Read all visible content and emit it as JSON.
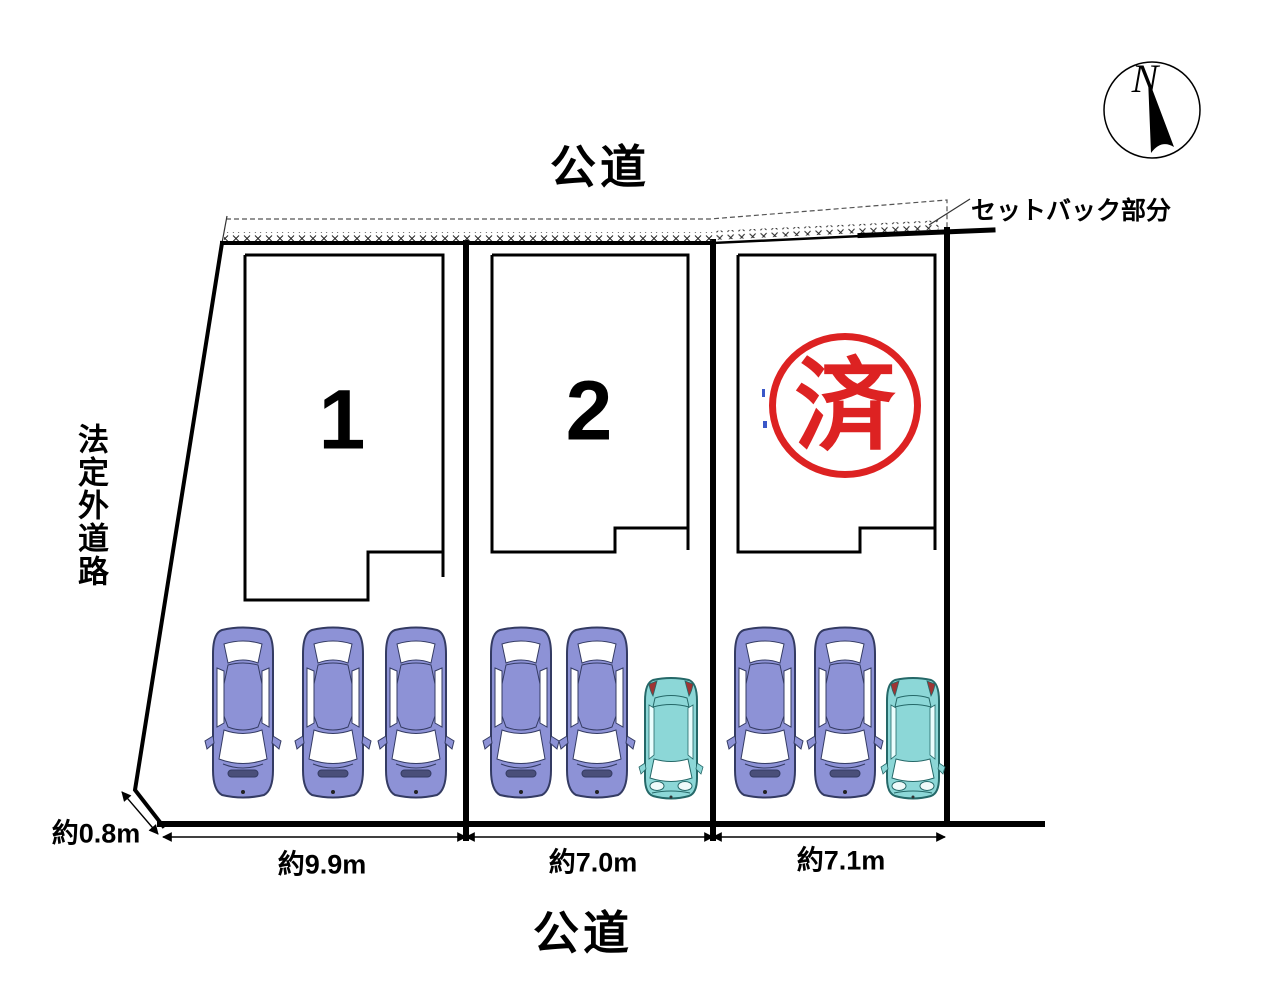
{
  "labels": {
    "road_top": "公道",
    "road_bottom": "公道",
    "side_road": "法定外道路",
    "setback": "セットバック部分",
    "compass_north": "N"
  },
  "lots": [
    {
      "number": "1",
      "frontage": "約9.9m",
      "status": "available",
      "cars_parked": 3
    },
    {
      "number": "2",
      "frontage": "約7.0m",
      "status": "available",
      "cars_parked": 3
    },
    {
      "stamp": "済",
      "frontage": "約7.1m",
      "status": "sold",
      "cars_parked": 3
    }
  ],
  "dimensions": {
    "side_offset": "約0.8m"
  },
  "icons": {
    "compass_needle": "north-arrow",
    "car_sedan": "top-view-sedan",
    "car_compact": "top-view-compact-car"
  },
  "colors": {
    "stamp_red": "#dd2222",
    "car_purple": "#8d92d6",
    "car_teal": "#8cd7d7",
    "line_black": "#000000"
  }
}
